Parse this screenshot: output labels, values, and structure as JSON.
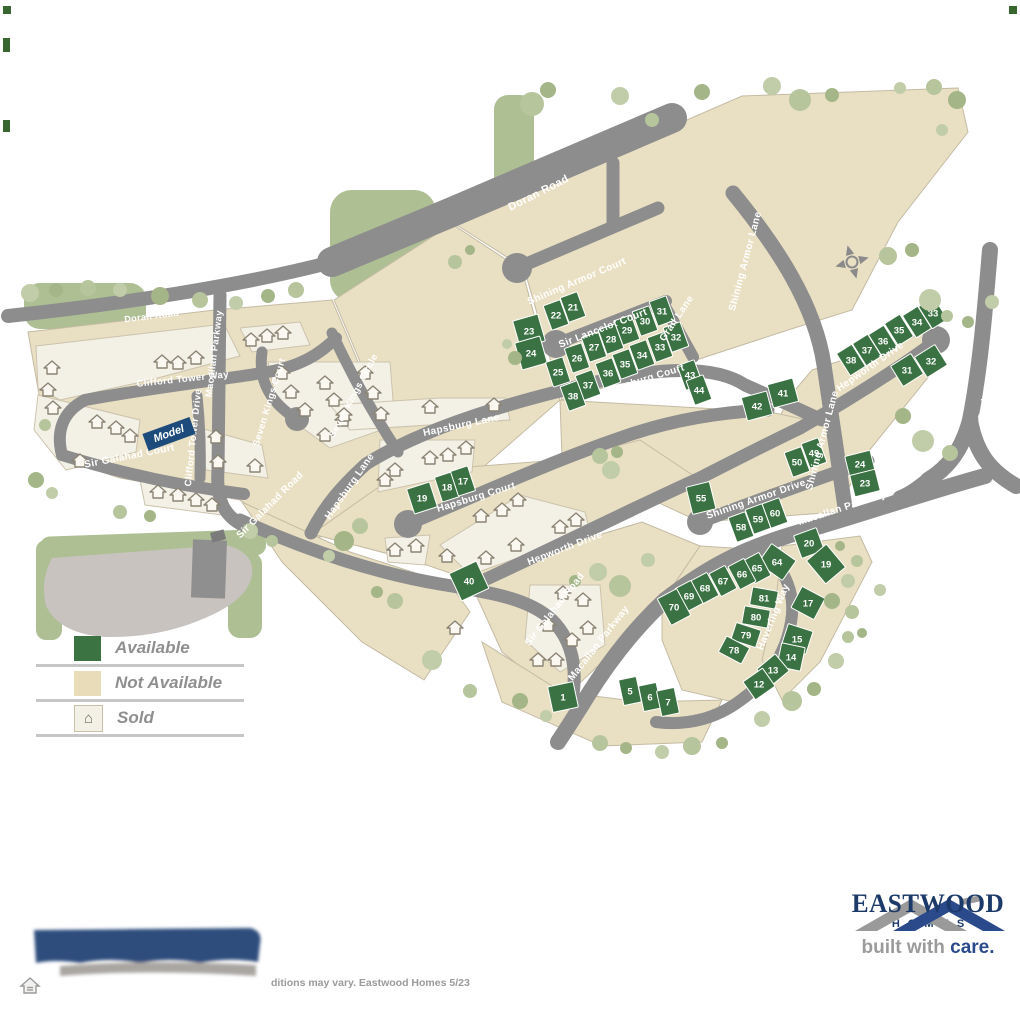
{
  "legend": {
    "items": [
      {
        "key": "available",
        "label": "Available"
      },
      {
        "key": "not_available",
        "label": "Not Available"
      },
      {
        "key": "sold",
        "label": "Sold"
      }
    ]
  },
  "model_label": "Model",
  "footer": {
    "disclaimer_visible": "ditions may vary. Eastwood Homes 5/23"
  },
  "brand": {
    "name": "EASTWOOD",
    "sub": "HOMES",
    "tagline_gray": "built with ",
    "tagline_blue": "care."
  },
  "colors": {
    "road": "#8d8d8d",
    "tan": "#e9dfc2",
    "cream": "#f3f0e6",
    "available_green": "#3b7243",
    "sage": "#b7c59d",
    "navy": "#1c3a69",
    "model_blue": "#1d4b7c"
  },
  "map": {
    "streets": [
      {
        "name": "Doran Road",
        "x": 540,
        "y": 196,
        "r": -27,
        "s": 11
      },
      {
        "name": "Doran Road",
        "x": 152,
        "y": 319,
        "r": -7,
        "s": 9
      },
      {
        "name": "Shining Armor Court",
        "x": 578,
        "y": 284,
        "r": -23,
        "s": 10
      },
      {
        "name": "Sir Lancelot Court",
        "x": 604,
        "y": 331,
        "r": -21,
        "s": 10
      },
      {
        "name": "Grail Lane",
        "x": 679,
        "y": 320,
        "r": -56,
        "s": 10
      },
      {
        "name": "Shining Armor Lane",
        "x": 748,
        "y": 262,
        "r": -75,
        "s": 10
      },
      {
        "name": "Shining Armor Lane",
        "x": 825,
        "y": 441,
        "r": -75,
        "s": 10
      },
      {
        "name": "Hapsburg Court",
        "x": 646,
        "y": 382,
        "r": -17,
        "s": 10
      },
      {
        "name": "Hapsburg Lane",
        "x": 462,
        "y": 428,
        "r": -12,
        "s": 10
      },
      {
        "name": "Hapsburg Lane",
        "x": 352,
        "y": 488,
        "r": -55,
        "s": 10
      },
      {
        "name": "Hapsburg Court",
        "x": 477,
        "y": 500,
        "r": -17,
        "s": 10
      },
      {
        "name": "Hepworth Drive",
        "x": 566,
        "y": 551,
        "r": -21,
        "s": 10
      },
      {
        "name": "Hepworth Drive",
        "x": 872,
        "y": 369,
        "r": -35,
        "s": 10
      },
      {
        "name": "Darbytown Road",
        "x": 992,
        "y": 378,
        "r": -80,
        "s": 10
      },
      {
        "name": "Macallan Parkway",
        "x": 217,
        "y": 354,
        "r": -83,
        "s": 9.5
      },
      {
        "name": "Macallan Parkway",
        "x": 843,
        "y": 511,
        "r": -18,
        "s": 10
      },
      {
        "name": "Macallan Parkway",
        "x": 601,
        "y": 645,
        "r": -52,
        "s": 10
      },
      {
        "name": "Clifford Tower Way",
        "x": 183,
        "y": 382,
        "r": -6,
        "s": 9.5
      },
      {
        "name": "Clifford Tower Drive",
        "x": 196,
        "y": 438,
        "r": -84,
        "s": 9.5
      },
      {
        "name": "Seven Kings Court",
        "x": 272,
        "y": 403,
        "r": -73,
        "s": 9.5
      },
      {
        "name": "Seven Kings Circle",
        "x": 356,
        "y": 397,
        "r": -62,
        "s": 9.5
      },
      {
        "name": "Sir Galahad Court",
        "x": 130,
        "y": 459,
        "r": -11,
        "s": 10
      },
      {
        "name": "Sir Galahad Road",
        "x": 272,
        "y": 507,
        "r": -45,
        "s": 10
      },
      {
        "name": "Sir Galahad Road",
        "x": 557,
        "y": 611,
        "r": -52,
        "s": 10
      },
      {
        "name": "Shining Armor Drive",
        "x": 757,
        "y": 502,
        "r": -19,
        "s": 10
      },
      {
        "name": "Havering Way",
        "x": 776,
        "y": 618,
        "r": -68,
        "s": 10
      }
    ],
    "lots": [
      [
        "21",
        573,
        307,
        -20
      ],
      [
        "22",
        556,
        315,
        -20
      ],
      [
        "23",
        529,
        331,
        -16,
        26,
        28
      ],
      [
        "24",
        531,
        353,
        -16,
        26,
        28
      ],
      [
        "25",
        558,
        372,
        -18
      ],
      [
        "26",
        577,
        358,
        -19
      ],
      [
        "27",
        594,
        347,
        -19
      ],
      [
        "28",
        611,
        339,
        -20
      ],
      [
        "29",
        627,
        330,
        -20
      ],
      [
        "30",
        645,
        321,
        -20
      ],
      [
        "31",
        662,
        311,
        -20
      ],
      [
        "32",
        676,
        337,
        -20
      ],
      [
        "33",
        660,
        347,
        -20
      ],
      [
        "34",
        642,
        355,
        -20
      ],
      [
        "35",
        625,
        364,
        -20
      ],
      [
        "36",
        608,
        373,
        -20
      ],
      [
        "37",
        588,
        385,
        -20
      ],
      [
        "38",
        573,
        396,
        -20
      ],
      [
        "43",
        690,
        375,
        -20
      ],
      [
        "44",
        699,
        390,
        -20
      ],
      [
        "42",
        757,
        406,
        -15,
        26,
        24
      ],
      [
        "41",
        783,
        393,
        -15,
        26,
        24
      ],
      [
        "38",
        851,
        360,
        -32
      ],
      [
        "37",
        867,
        350,
        -32
      ],
      [
        "36",
        883,
        341,
        -32
      ],
      [
        "35",
        899,
        330,
        -32
      ],
      [
        "34",
        917,
        322,
        -32
      ],
      [
        "33",
        933,
        313,
        -32
      ],
      [
        "31",
        907,
        370,
        -32,
        24,
        24
      ],
      [
        "32",
        931,
        361,
        -32,
        24,
        24
      ],
      [
        "50",
        797,
        462,
        -20
      ],
      [
        "49",
        814,
        453,
        -20
      ],
      [
        "24",
        860,
        464,
        -14,
        26,
        22
      ],
      [
        "23",
        865,
        483,
        -14,
        26,
        22
      ],
      [
        "55",
        701,
        498,
        -14,
        24,
        28
      ],
      [
        "58",
        741,
        527,
        -20
      ],
      [
        "59",
        758,
        519,
        -20
      ],
      [
        "60",
        775,
        513,
        -20
      ],
      [
        "20",
        809,
        543,
        -20,
        24,
        24
      ],
      [
        "64",
        777,
        562,
        -55,
        24,
        30
      ],
      [
        "65",
        757,
        568,
        -28
      ],
      [
        "66",
        742,
        574,
        -28
      ],
      [
        "67",
        723,
        581,
        -28
      ],
      [
        "68",
        705,
        588,
        -28
      ],
      [
        "69",
        689,
        596,
        -28
      ],
      [
        "70",
        674,
        607,
        -28,
        22,
        30
      ],
      [
        "81",
        764,
        598,
        -80
      ],
      [
        "80",
        756,
        617,
        -80
      ],
      [
        "79",
        746,
        635,
        -72
      ],
      [
        "78",
        734,
        650,
        -62
      ],
      [
        "19",
        826,
        564,
        -40,
        26,
        30
      ],
      [
        "17",
        808,
        603,
        -62,
        24,
        26
      ],
      [
        "15",
        797,
        639,
        -72,
        24,
        26
      ],
      [
        "14",
        791,
        657,
        -78,
        24,
        24
      ],
      [
        "13",
        773,
        670,
        -40,
        24,
        22
      ],
      [
        "12",
        759,
        684,
        -35,
        24,
        22
      ],
      [
        "19",
        422,
        498,
        -18,
        24,
        26
      ],
      [
        "18",
        447,
        487,
        -18
      ],
      [
        "17",
        463,
        481,
        -18
      ],
      [
        "40",
        469,
        581,
        -25,
        30,
        30
      ],
      [
        "1",
        563,
        697,
        -12,
        26,
        26
      ],
      [
        "5",
        630,
        691,
        -12
      ],
      [
        "6",
        650,
        697,
        -12
      ],
      [
        "7",
        668,
        702,
        -12
      ]
    ],
    "houses": [
      [
        162,
        362
      ],
      [
        178,
        363
      ],
      [
        196,
        358
      ],
      [
        52,
        368
      ],
      [
        48,
        390
      ],
      [
        53,
        408
      ],
      [
        97,
        422
      ],
      [
        116,
        428
      ],
      [
        130,
        436
      ],
      [
        80,
        461
      ],
      [
        216,
        437
      ],
      [
        218,
        462
      ],
      [
        255,
        466
      ],
      [
        158,
        492
      ],
      [
        178,
        495
      ],
      [
        196,
        500
      ],
      [
        212,
        505
      ],
      [
        251,
        340
      ],
      [
        267,
        336
      ],
      [
        283,
        333
      ],
      [
        282,
        373
      ],
      [
        291,
        392
      ],
      [
        305,
        410
      ],
      [
        325,
        383
      ],
      [
        334,
        400
      ],
      [
        343,
        420
      ],
      [
        325,
        435
      ],
      [
        365,
        373
      ],
      [
        373,
        393
      ],
      [
        381,
        414
      ],
      [
        344,
        415
      ],
      [
        430,
        407
      ],
      [
        494,
        405
      ],
      [
        430,
        458
      ],
      [
        448,
        455
      ],
      [
        466,
        448
      ],
      [
        395,
        470
      ],
      [
        385,
        480
      ],
      [
        395,
        550
      ],
      [
        416,
        546
      ],
      [
        481,
        516
      ],
      [
        502,
        510
      ],
      [
        518,
        500
      ],
      [
        447,
        556
      ],
      [
        486,
        558
      ],
      [
        516,
        545
      ],
      [
        560,
        527
      ],
      [
        576,
        520
      ],
      [
        563,
        593
      ],
      [
        583,
        600
      ],
      [
        548,
        625
      ],
      [
        588,
        628
      ],
      [
        572,
        640
      ],
      [
        556,
        660
      ],
      [
        538,
        660
      ],
      [
        455,
        628
      ]
    ],
    "trees": [
      [
        532,
        104,
        12
      ],
      [
        548,
        90,
        8
      ],
      [
        620,
        96,
        9
      ],
      [
        652,
        120,
        7
      ],
      [
        702,
        92,
        8
      ],
      [
        772,
        86,
        9
      ],
      [
        800,
        100,
        11
      ],
      [
        832,
        95,
        7
      ],
      [
        900,
        88,
        6
      ],
      [
        934,
        87,
        8
      ],
      [
        957,
        100,
        9
      ],
      [
        942,
        130,
        6
      ],
      [
        888,
        256,
        9
      ],
      [
        912,
        250,
        7
      ],
      [
        930,
        300,
        11
      ],
      [
        947,
        316,
        6
      ],
      [
        903,
        416,
        8
      ],
      [
        923,
        441,
        11
      ],
      [
        950,
        453,
        8
      ],
      [
        968,
        322,
        6
      ],
      [
        992,
        302,
        7
      ],
      [
        296,
        290,
        8
      ],
      [
        268,
        296,
        7
      ],
      [
        236,
        303,
        7
      ],
      [
        200,
        300,
        8
      ],
      [
        160,
        296,
        9
      ],
      [
        120,
        290,
        7
      ],
      [
        88,
        288,
        8
      ],
      [
        56,
        290,
        7
      ],
      [
        30,
        293,
        9
      ],
      [
        45,
        425,
        6
      ],
      [
        36,
        480,
        8
      ],
      [
        52,
        493,
        6
      ],
      [
        120,
        512,
        7
      ],
      [
        150,
        516,
        6
      ],
      [
        250,
        531,
        8
      ],
      [
        272,
        541,
        6
      ],
      [
        515,
        358,
        7
      ],
      [
        507,
        344,
        5
      ],
      [
        600,
        456,
        8
      ],
      [
        617,
        452,
        6
      ],
      [
        611,
        470,
        9
      ],
      [
        360,
        526,
        8
      ],
      [
        344,
        541,
        10
      ],
      [
        329,
        556,
        6
      ],
      [
        395,
        601,
        8
      ],
      [
        377,
        592,
        6
      ],
      [
        432,
        660,
        10
      ],
      [
        470,
        691,
        7
      ],
      [
        520,
        701,
        8
      ],
      [
        546,
        716,
        6
      ],
      [
        600,
        743,
        8
      ],
      [
        626,
        748,
        6
      ],
      [
        662,
        752,
        7
      ],
      [
        692,
        746,
        9
      ],
      [
        722,
        743,
        6
      ],
      [
        762,
        719,
        8
      ],
      [
        792,
        701,
        10
      ],
      [
        814,
        689,
        7
      ],
      [
        836,
        661,
        8
      ],
      [
        848,
        637,
        6
      ],
      [
        832,
        601,
        8
      ],
      [
        848,
        581,
        7
      ],
      [
        857,
        561,
        6
      ],
      [
        840,
        546,
        5
      ],
      [
        598,
        572,
        9
      ],
      [
        620,
        586,
        11
      ],
      [
        575,
        581,
        6
      ],
      [
        648,
        560,
        7
      ],
      [
        852,
        612,
        7
      ],
      [
        862,
        633,
        5
      ],
      [
        880,
        590,
        6
      ],
      [
        455,
        262,
        7
      ],
      [
        470,
        250,
        5
      ]
    ]
  }
}
